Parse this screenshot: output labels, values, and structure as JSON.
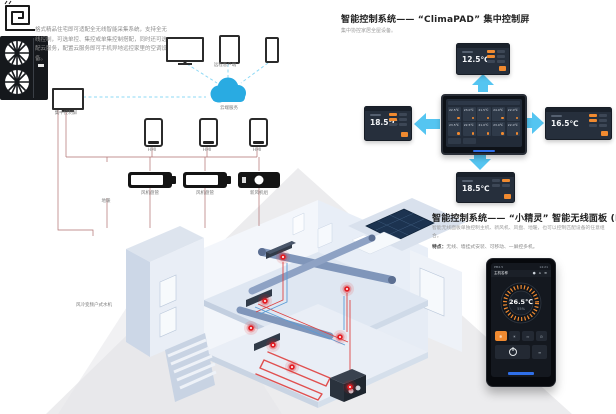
{
  "left_diagram": {
    "intro_text": "格式精品住宅即可适配全无线智能采集系统，支持全无线控制，可选单控、集控或单集控制搭配，同时还可选配云服务，配置云服务即可手机异地远控家里的空调设备。",
    "remote_clients_label": "远程客户端",
    "cloud_label": "云端服务",
    "central_screen_label": "集中控制屏",
    "panel_labels": [
      "HMI",
      "HMI",
      "HMI"
    ],
    "equipment_labels": [
      "地暖",
      "风机盘管",
      "风机盘管",
      "新风机组"
    ],
    "outdoor_unit_label": "风冷变频户式水机"
  },
  "climapad_section": {
    "title": "智能控制系统—— “ClimaPAD” 集中控制屏",
    "subtitle": "集中协控家居全屋设备。",
    "screens": {
      "top": "12.5℃",
      "left": "18.5℃",
      "right": "16.5℃",
      "bottom": "18.5℃"
    },
    "tablet_grid": [
      {
        "temp": "22.5℃"
      },
      {
        "temp": "23.0℃"
      },
      {
        "temp": "21.5℃"
      },
      {
        "temp": "24.0℃"
      },
      {
        "temp": "22.0℃"
      },
      {
        "temp": "23.5℃"
      },
      {
        "temp": "22.5℃"
      },
      {
        "temp": "21.0℃"
      },
      {
        "temp": "23.0℃"
      },
      {
        "temp": "22.0℃"
      }
    ]
  },
  "hmi_section": {
    "title": "智能控制系统—— “小精灵” 智能无线面板 (HMI)",
    "description": "智能无线面板单独控制主机、新风机、风盘、地暖，也可以控制匹配设备的任意组合。",
    "features_label": "特点：",
    "features_text": "无线、墙挂式安装、可移动、一屏控多机。",
    "panel": {
      "pm_label": "PM2.5",
      "time": "14:21",
      "device_name": "主机名称",
      "status_icons": "● ⌂ ≡",
      "temp": "26.5℃",
      "humidity": "55%",
      "mode_icons": [
        "❄",
        "☀",
        "≈",
        "⊙"
      ]
    }
  },
  "accent_colors": {
    "orange": "#f08a30",
    "arrow_blue": "#55c5f1",
    "cloud_blue": "#29abe2",
    "marker_red": "#e31e24"
  }
}
